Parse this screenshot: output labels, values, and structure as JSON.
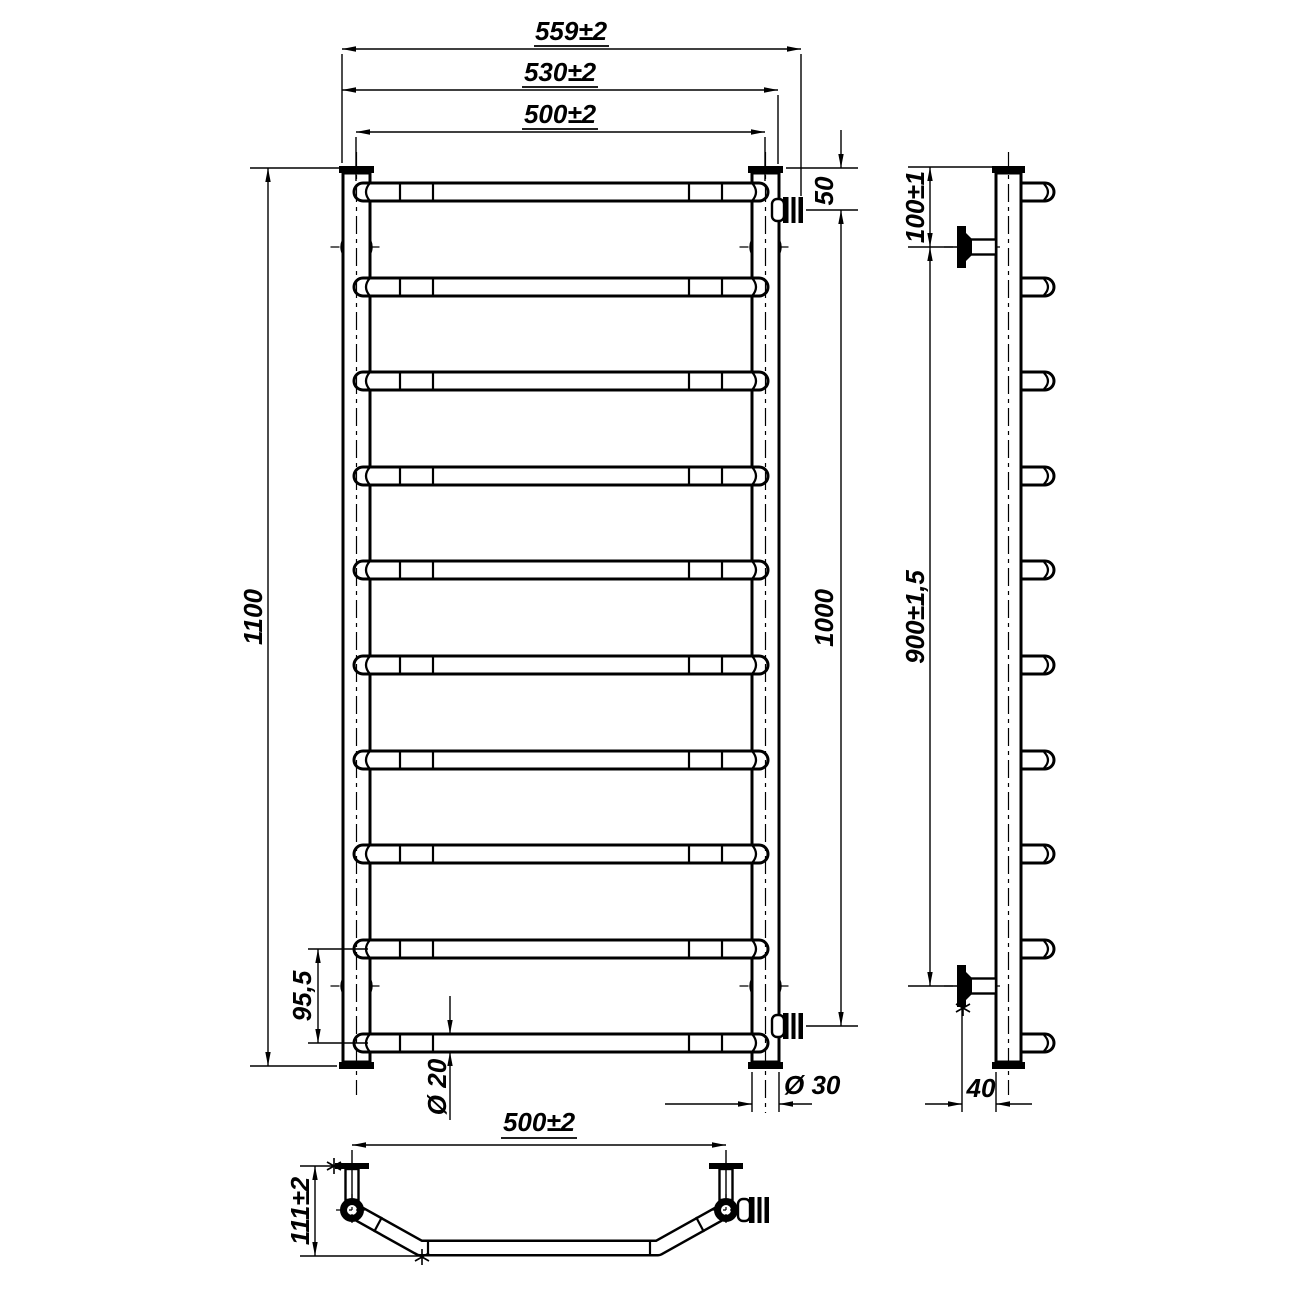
{
  "dimensions": {
    "front_view": {
      "overall_width": "559±2",
      "pipe_outer_width": "530±2",
      "rung_length": "500±2",
      "top_to_connector": "50",
      "total_height": "1100",
      "connector_spacing": "1000",
      "bottom_rung_spacing": "95,5",
      "rung_diameter": "Ø 20",
      "pipe_diameter": "Ø 30"
    },
    "side_view": {
      "top_to_bracket": "100±1",
      "bracket_spacing": "900±1,5",
      "wall_offset": "40"
    },
    "bottom_view": {
      "mounting_width": "500±2",
      "depth": "111±2"
    }
  }
}
